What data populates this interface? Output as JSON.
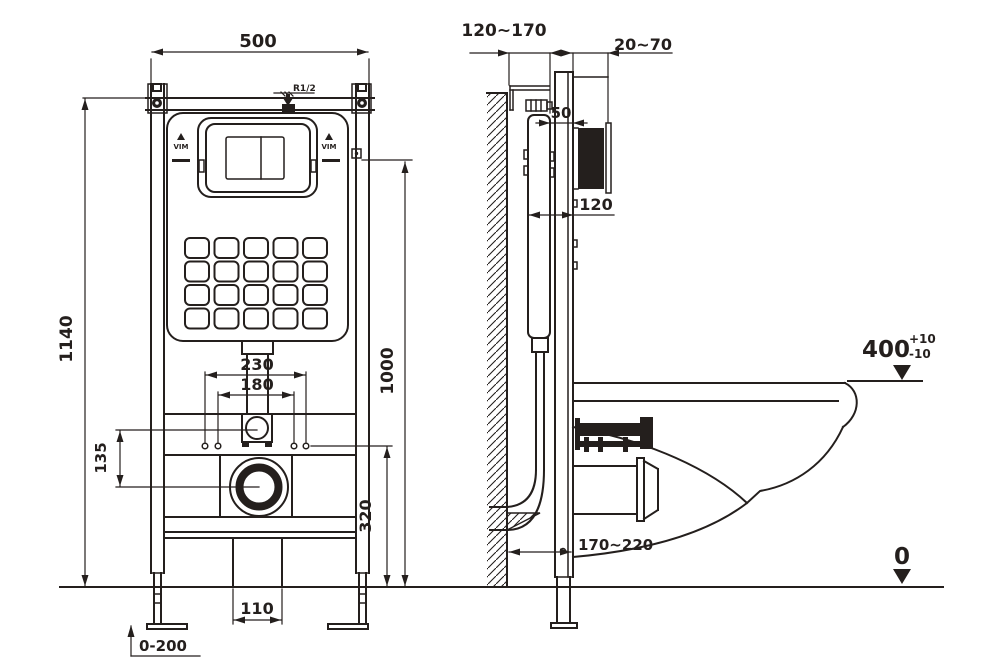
{
  "drawing": {
    "front": {
      "dim_width": "500",
      "dim_total_height": "1140",
      "dim_plate_height": "1000",
      "dim_bolt_outer": "230",
      "dim_bolt_inner": "180",
      "dim_offset": "135",
      "dim_drain_height": "320",
      "dim_outlet_width": "110",
      "dim_leg_adjust": "0-200",
      "inlet_thread": "R1/2",
      "brand_left": "VIM",
      "brand_right": "VIM"
    },
    "side": {
      "dim_frame_depth": "120~170",
      "dim_plate_depth": "20~70",
      "dim_gap": "50",
      "dim_recess": "120",
      "dim_drain_offset": "170~220",
      "dim_bowl_height": "400",
      "tol_plus": "+10",
      "tol_minus": "-10",
      "datum_floor": "0"
    },
    "colors": {
      "ink": "#241f1d",
      "paper": "#ffffff"
    }
  }
}
